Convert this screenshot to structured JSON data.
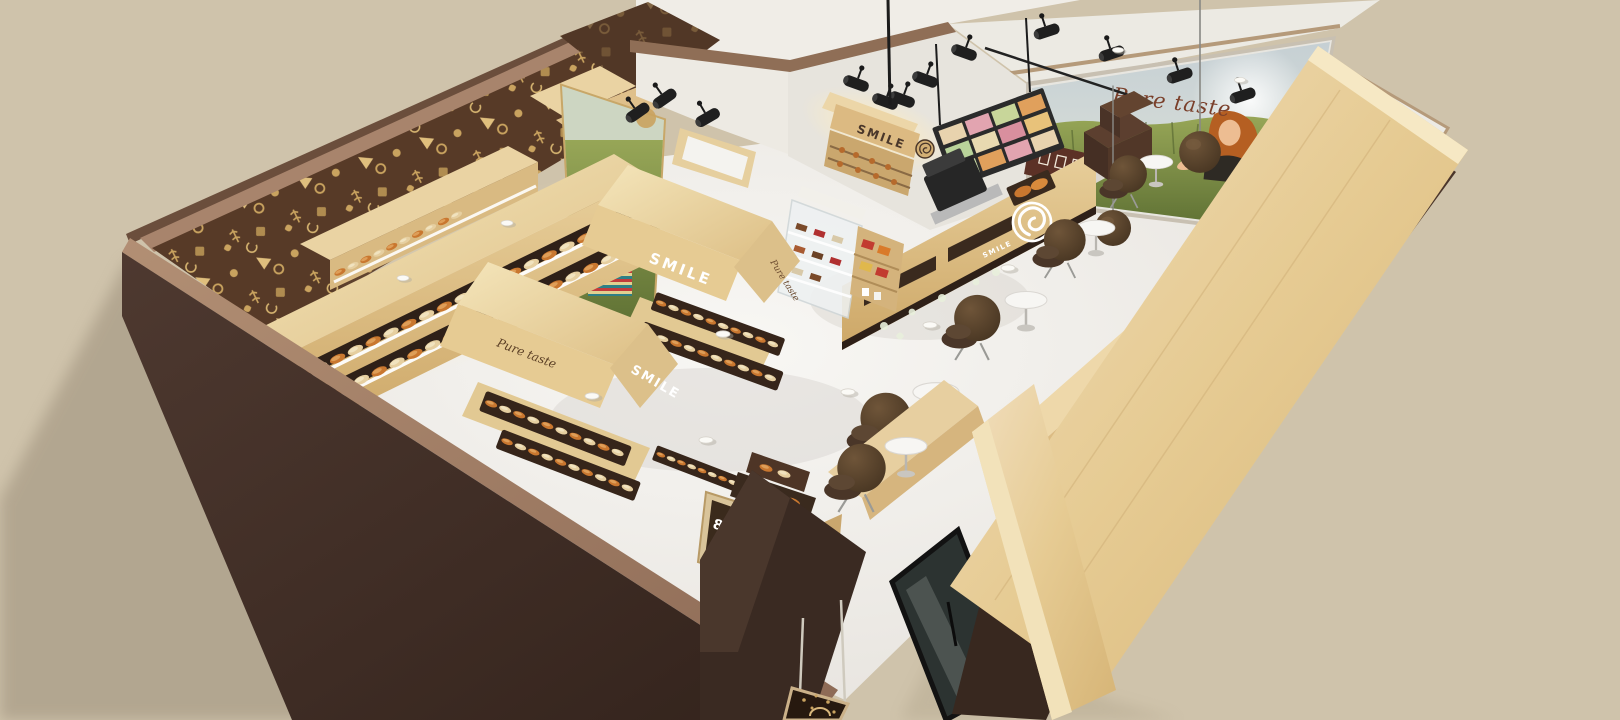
{
  "scene": {
    "background_color": "#cfc3ab",
    "branding": {
      "mural_slogan": "Pure taste",
      "wall_sign_text": "SMILE",
      "island_a_front_text": "SMILE",
      "island_a_end_text": "Pure taste",
      "island_b_side_text": "Pure taste",
      "island_b_end_text": "SMILE",
      "counter_front_text": "SMILE",
      "kiosk_price_text": "8"
    },
    "palette": {
      "background": "#cfc3ab",
      "exterior_wall_dark_brown": "#42302a",
      "wall_trim_mauve": "#a8846c",
      "wallpaper_brown": "#573a27",
      "wallpaper_gold": "#c9a35f",
      "wood_light": "#eedcac",
      "wood_mid": "#d9bc84",
      "floor_white": "#f4f2ef",
      "chair_brown": "#55402f",
      "bread_crust_orange": "#c9772f",
      "mural_field_green": "#6f8140",
      "mural_sky_gray": "#c2cdd1",
      "slogan_brown": "#7a3f2a",
      "glass_door_dark": "#2c3331"
    },
    "icons": {
      "logo": "pretzel-swirl-icon",
      "lighting": "track-spotlight-icon",
      "pendant": "sphere-pendant-lamp-icon",
      "downlight": "white-puck-light-icon"
    }
  }
}
